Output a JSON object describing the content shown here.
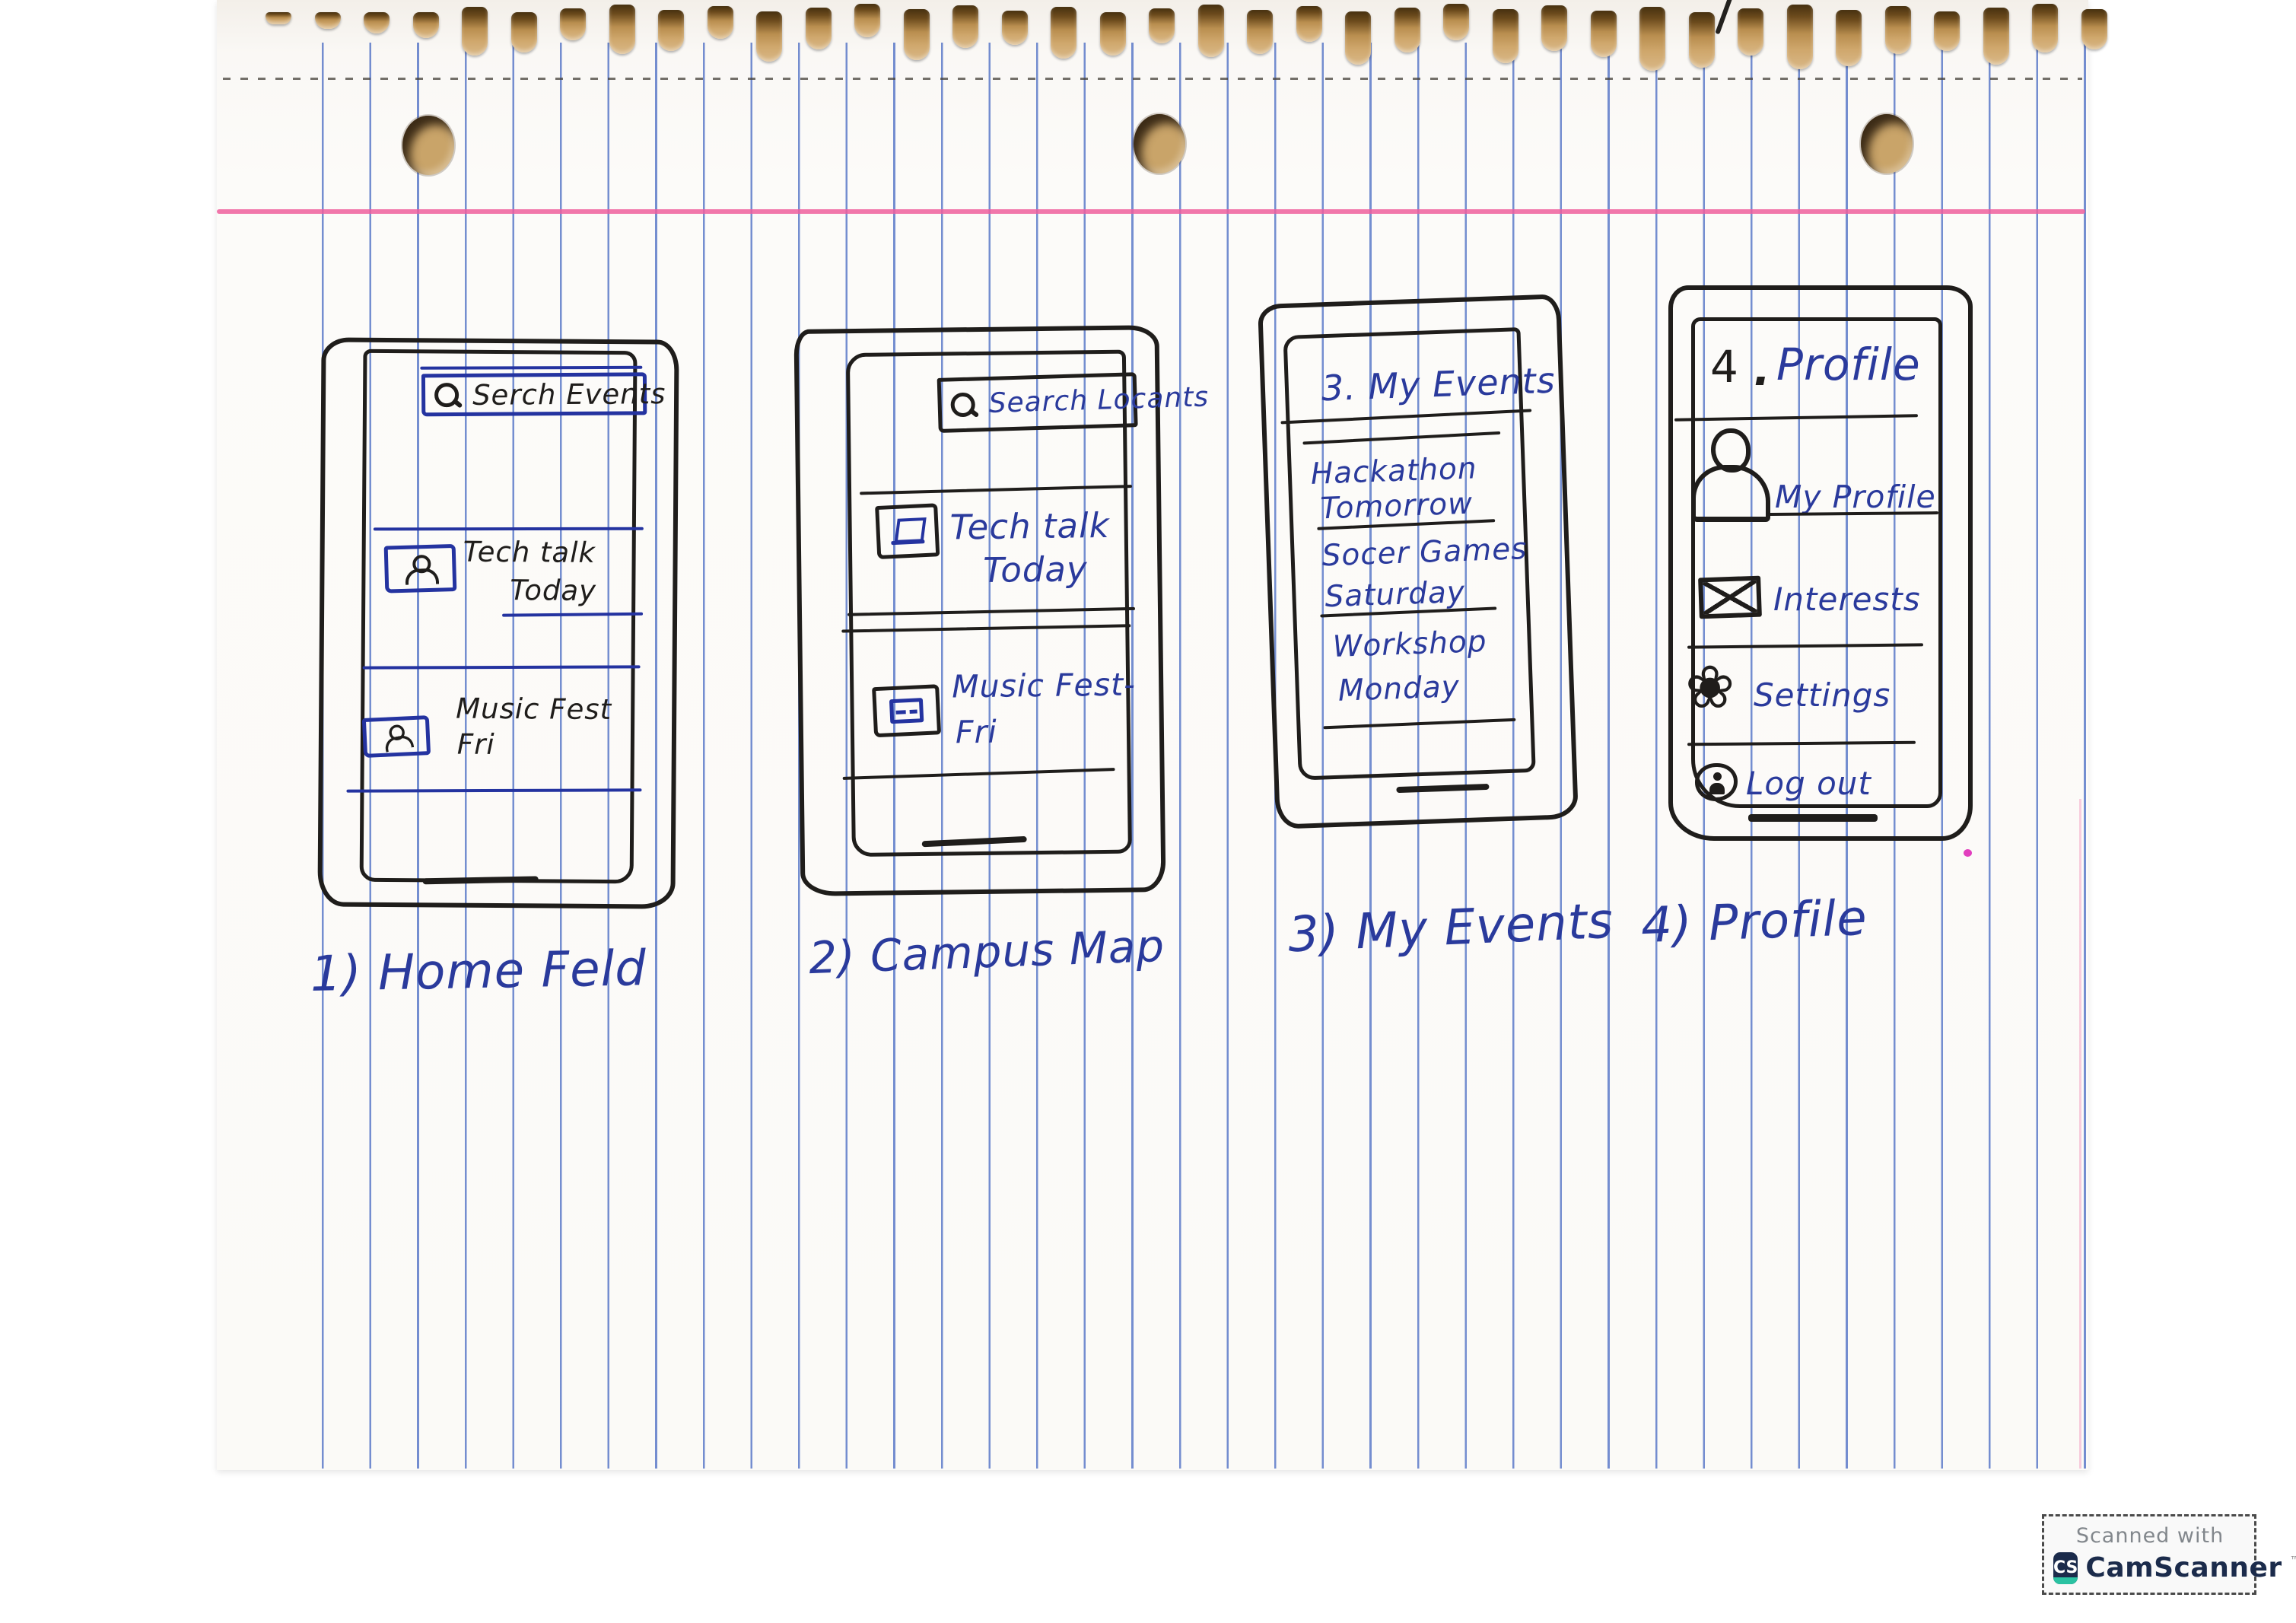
{
  "colors": {
    "ink_black": "#1f1d1b",
    "ink_blue": "#2a3a9c",
    "box_blue": "#2433a0",
    "ruled_line": "#3f63c0",
    "margin_pink": "#ee5f9e",
    "badge_navy": "#1b2b4b",
    "badge_teal": "#2bc2a2",
    "badge_gray": "#82878c"
  },
  "paper": {
    "spiral_hole_count": 38,
    "punch_hole_count": 3
  },
  "phones": [
    {
      "caption": "1) Home Feld",
      "search": {
        "icon": "magnifier-icon",
        "label": "Serch Events"
      },
      "cards": [
        {
          "icon": "person-photo-icon",
          "title": "Tech talk",
          "subtitle": "Today"
        },
        {
          "icon": "person-photo-icon",
          "title": "Music Fest",
          "subtitle": "Fri"
        }
      ]
    },
    {
      "caption": "2) Campus Map",
      "search": {
        "icon": "magnifier-icon",
        "label": "Search Locants"
      },
      "cards": [
        {
          "icon": "laptop-icon",
          "title": "Tech talk",
          "subtitle": "Today"
        },
        {
          "icon": "image-icon",
          "title": "Music Fest-",
          "subtitle": "Fri"
        }
      ]
    },
    {
      "caption": "3) My Events",
      "header": "3. My Events",
      "events": [
        {
          "title": "Hackathon",
          "when": "Tomorrow"
        },
        {
          "title": "Socer Games",
          "when": "Saturday"
        },
        {
          "title": "Workshop",
          "when": "Monday"
        }
      ]
    },
    {
      "caption": "4) Profile",
      "header_number": "4",
      "header_dot": ".",
      "header_title": "Profile",
      "menu": [
        {
          "icon": "person-icon",
          "label": "My Profile"
        },
        {
          "icon": "envelope-icon",
          "label": "Interests"
        },
        {
          "icon": "flower-gear-icon",
          "label": "Settings",
          "glyph": "❀"
        },
        {
          "icon": "person-circle-icon",
          "label": "Log out"
        }
      ]
    }
  ],
  "watermark": {
    "line1": "Scanned with",
    "logo_text": "CS",
    "app_name": "CamScanner",
    "tm": "™"
  }
}
